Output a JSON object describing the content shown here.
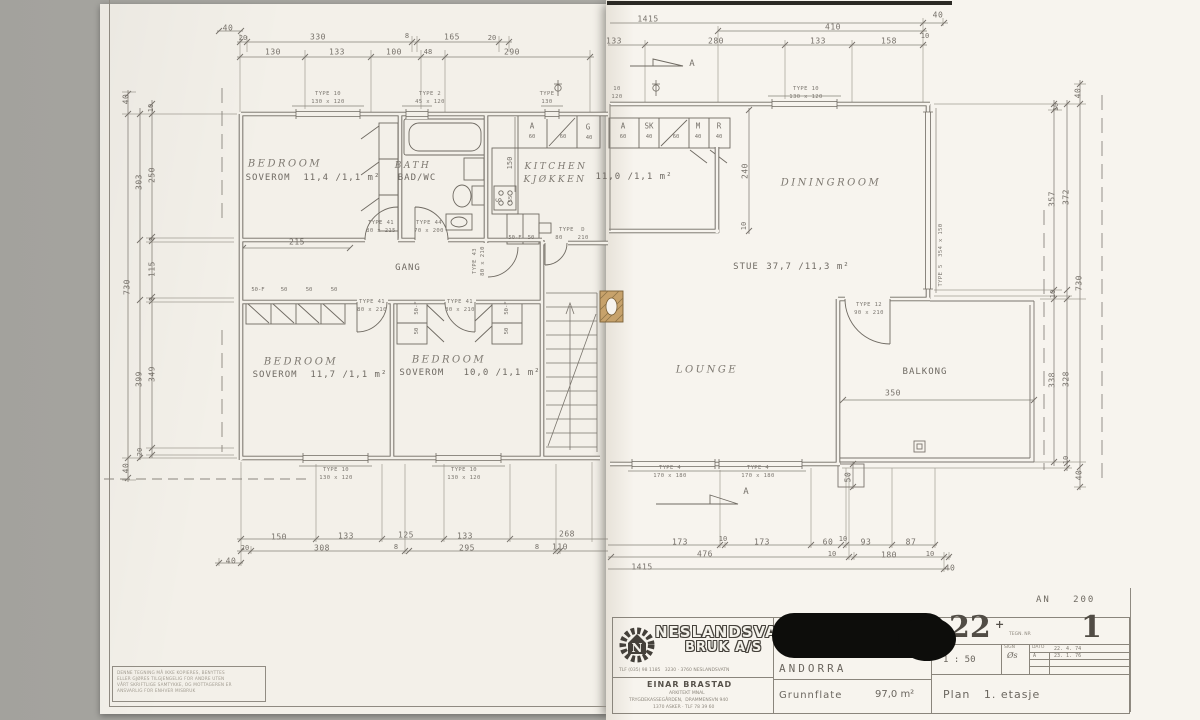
{
  "page": {
    "backdrop": "#a8a7a2",
    "paper_left": "#f3f0e9",
    "paper_right": "#f7f4ee",
    "ink": "#6f6a62",
    "chimney_fill": "#c7a26b",
    "redaction": "#0d0d0b"
  },
  "plan": {
    "rooms": [
      {
        "name_en": "BEDROOM",
        "name_no": "SOVEROM",
        "area": "11,4 /1,1 m²"
      },
      {
        "name_en": "BATH",
        "name_no": "BAD/WC"
      },
      {
        "name_en": "KITCHEN",
        "name_no": "KJØKKEN",
        "area": "11,0 /1,1 m²"
      },
      {
        "name_en": "DININGROOM",
        "name_no": "STUE",
        "area": "37,7 /11,3 m²"
      },
      {
        "name_en": "LOUNGE"
      },
      {
        "name_no": "BALKONG"
      },
      {
        "name_en": "BEDROOM",
        "name_no": "SOVEROM",
        "area": "11,7 /1,1 m²"
      },
      {
        "name_en": "BEDROOM",
        "name_no": "SOVEROM",
        "area": "10,0 /1,1 m²"
      },
      {
        "name_no": "GANG"
      }
    ],
    "labels": [
      {
        "t": "40",
        "x": 228,
        "y": 28,
        "c": "dim"
      },
      {
        "t": "20",
        "x": 243,
        "y": 38,
        "c": "dimS"
      },
      {
        "t": "330",
        "x": 318,
        "y": 37,
        "c": "dim"
      },
      {
        "t": "8",
        "x": 407,
        "y": 36,
        "c": "dimS"
      },
      {
        "t": "165",
        "x": 452,
        "y": 37,
        "c": "dim"
      },
      {
        "t": "20",
        "x": 492,
        "y": 38,
        "c": "dimS"
      },
      {
        "t": "130",
        "x": 273,
        "y": 52,
        "c": "dim"
      },
      {
        "t": "133",
        "x": 337,
        "y": 52,
        "c": "dim"
      },
      {
        "t": "100",
        "x": 394,
        "y": 52,
        "c": "dim"
      },
      {
        "t": "48",
        "x": 428,
        "y": 52,
        "c": "dimS"
      },
      {
        "t": "290",
        "x": 512,
        "y": 52,
        "c": "dim"
      },
      {
        "t": "1415",
        "x": 648,
        "y": 19,
        "c": "dim"
      },
      {
        "t": "410",
        "x": 833,
        "y": 27,
        "c": "dim"
      },
      {
        "t": "40",
        "x": 938,
        "y": 15,
        "c": "dim"
      },
      {
        "t": "133",
        "x": 614,
        "y": 41,
        "c": "dim"
      },
      {
        "t": "280",
        "x": 716,
        "y": 41,
        "c": "dim"
      },
      {
        "t": "133",
        "x": 818,
        "y": 41,
        "c": "dim"
      },
      {
        "t": "158",
        "x": 889,
        "y": 41,
        "c": "dim"
      },
      {
        "t": "10",
        "x": 925,
        "y": 36,
        "c": "dimS"
      },
      {
        "t": "A",
        "x": 692,
        "y": 64,
        "c": "secA"
      },
      {
        "t": "A",
        "x": 746,
        "y": 492,
        "c": "secA"
      },
      {
        "t": "TYPE 10",
        "x": 328,
        "y": 94,
        "c": "tiny"
      },
      {
        "t": "130 x 120",
        "x": 328,
        "y": 102,
        "c": "tiny"
      },
      {
        "t": "TYPE 2",
        "x": 430,
        "y": 94,
        "c": "tiny"
      },
      {
        "t": "45 x 120",
        "x": 430,
        "y": 102,
        "c": "tiny"
      },
      {
        "t": "TYPE",
        "x": 547,
        "y": 94,
        "c": "tiny"
      },
      {
        "t": "130",
        "x": 547,
        "y": 102,
        "c": "tiny"
      },
      {
        "t": "10",
        "x": 617,
        "y": 89,
        "c": "tiny"
      },
      {
        "t": "120",
        "x": 617,
        "y": 97,
        "c": "tiny"
      },
      {
        "t": "TYPE 10",
        "x": 806,
        "y": 89,
        "c": "tiny"
      },
      {
        "t": "130 x 120",
        "x": 806,
        "y": 97,
        "c": "tiny"
      },
      {
        "t": "TYPE 5  354 x 150",
        "x": 941,
        "y": 255,
        "c": "tiny rot"
      },
      {
        "t": "TYPE 12",
        "x": 869,
        "y": 305,
        "c": "tiny"
      },
      {
        "t": "90 x 210",
        "x": 869,
        "y": 313,
        "c": "tiny"
      },
      {
        "t": "TYPE 41",
        "x": 381,
        "y": 223,
        "c": "tiny"
      },
      {
        "t": "80 x 215",
        "x": 381,
        "y": 231,
        "c": "tiny"
      },
      {
        "t": "TYPE 44",
        "x": 429,
        "y": 223,
        "c": "tiny"
      },
      {
        "t": "70 x 200",
        "x": 429,
        "y": 231,
        "c": "tiny"
      },
      {
        "t": "TYPE 43",
        "x": 475,
        "y": 261,
        "c": "tiny rot"
      },
      {
        "t": "80 x 210",
        "x": 483,
        "y": 261,
        "c": "tiny rot"
      },
      {
        "t": "TYPE  D",
        "x": 572,
        "y": 230,
        "c": "tiny"
      },
      {
        "t": "80    210",
        "x": 572,
        "y": 238,
        "c": "tiny"
      },
      {
        "t": "TYPE 41",
        "x": 372,
        "y": 302,
        "c": "tiny"
      },
      {
        "t": "80 x 210",
        "x": 372,
        "y": 310,
        "c": "tiny"
      },
      {
        "t": "TYPE 41",
        "x": 460,
        "y": 302,
        "c": "tiny"
      },
      {
        "t": "80 x 210",
        "x": 460,
        "y": 310,
        "c": "tiny"
      },
      {
        "t": "TYPE 10",
        "x": 336,
        "y": 470,
        "c": "tiny"
      },
      {
        "t": "130 x 120",
        "x": 336,
        "y": 478,
        "c": "tiny"
      },
      {
        "t": "TYPE 10",
        "x": 464,
        "y": 470,
        "c": "tiny"
      },
      {
        "t": "130 x 120",
        "x": 464,
        "y": 478,
        "c": "tiny"
      },
      {
        "t": "TYPE 4",
        "x": 670,
        "y": 468,
        "c": "tiny"
      },
      {
        "t": "170 x 180",
        "x": 670,
        "y": 476,
        "c": "tiny"
      },
      {
        "t": "TYPE 4",
        "x": 758,
        "y": 468,
        "c": "tiny"
      },
      {
        "t": "170 x 180",
        "x": 758,
        "y": 476,
        "c": "tiny"
      },
      {
        "t": "A",
        "x": 532,
        "y": 126,
        "c": "clo"
      },
      {
        "t": "60",
        "x": 532,
        "y": 137,
        "c": "cloS"
      },
      {
        "t": "60",
        "x": 563,
        "y": 137,
        "c": "cloS"
      },
      {
        "t": "G",
        "x": 588,
        "y": 127,
        "c": "clo"
      },
      {
        "t": "40",
        "x": 589,
        "y": 138,
        "c": "cloS"
      },
      {
        "t": "A",
        "x": 623,
        "y": 126,
        "c": "clo"
      },
      {
        "t": "60",
        "x": 623,
        "y": 137,
        "c": "cloS"
      },
      {
        "t": "SK",
        "x": 649,
        "y": 126,
        "c": "clo"
      },
      {
        "t": "40",
        "x": 649,
        "y": 137,
        "c": "cloS"
      },
      {
        "t": "60",
        "x": 676,
        "y": 137,
        "c": "cloS"
      },
      {
        "t": "M",
        "x": 698,
        "y": 126,
        "c": "clo"
      },
      {
        "t": "40",
        "x": 698,
        "y": 137,
        "c": "cloS"
      },
      {
        "t": "R",
        "x": 719,
        "y": 126,
        "c": "clo"
      },
      {
        "t": "40",
        "x": 719,
        "y": 137,
        "c": "cloS"
      },
      {
        "t": "50-F",
        "x": 258,
        "y": 290,
        "c": "cloS"
      },
      {
        "t": "50",
        "x": 284,
        "y": 290,
        "c": "cloS"
      },
      {
        "t": "50",
        "x": 309,
        "y": 290,
        "c": "cloS"
      },
      {
        "t": "50",
        "x": 334,
        "y": 290,
        "c": "cloS"
      },
      {
        "t": "50-F",
        "x": 417,
        "y": 308,
        "c": "cloS rot"
      },
      {
        "t": "50",
        "x": 417,
        "y": 331,
        "c": "cloS rot"
      },
      {
        "t": "50-F",
        "x": 507,
        "y": 308,
        "c": "cloS rot"
      },
      {
        "t": "50",
        "x": 507,
        "y": 331,
        "c": "cloS rot"
      },
      {
        "t": "50-F",
        "x": 515,
        "y": 238,
        "c": "cloS"
      },
      {
        "t": "50",
        "x": 531,
        "y": 238,
        "c": "cloS"
      },
      {
        "t": "150",
        "x": 510,
        "y": 163,
        "c": "dimS rot"
      },
      {
        "t": "S",
        "x": 499,
        "y": 200,
        "c": "clo rot"
      },
      {
        "t": "55",
        "x": 511,
        "y": 199,
        "c": "cloS rot"
      },
      {
        "t": "BEDROOM",
        "x": 285,
        "y": 164,
        "c": "hw"
      },
      {
        "t": "SOVEROM  11,4 /1,1 m²",
        "x": 313,
        "y": 178,
        "c": "room"
      },
      {
        "t": "BATH",
        "x": 413,
        "y": 166,
        "c": "hw2"
      },
      {
        "t": "BAD/WC",
        "x": 417,
        "y": 178,
        "c": "room"
      },
      {
        "t": "KITCHEN",
        "x": 556,
        "y": 167,
        "c": "hw2"
      },
      {
        "t": "KJØKKEN",
        "x": 555,
        "y": 180,
        "c": "hw2"
      },
      {
        "t": "11,0 /1,1 m²",
        "x": 634,
        "y": 177,
        "c": "room"
      },
      {
        "t": "DININGROOM",
        "x": 831,
        "y": 183,
        "c": "hw"
      },
      {
        "t": "STUE",
        "x": 746,
        "y": 267,
        "c": "room"
      },
      {
        "t": "37,7 /11,3 m²",
        "x": 808,
        "y": 267,
        "c": "room"
      },
      {
        "t": "LOUNGE",
        "x": 707,
        "y": 370,
        "c": "hw"
      },
      {
        "t": "BALKONG",
        "x": 925,
        "y": 372,
        "c": "room"
      },
      {
        "t": "BEDROOM",
        "x": 301,
        "y": 362,
        "c": "hw"
      },
      {
        "t": "SOVEROM  11,7 /1,1 m²",
        "x": 320,
        "y": 375,
        "c": "room"
      },
      {
        "t": "BEDROOM",
        "x": 449,
        "y": 360,
        "c": "hw"
      },
      {
        "t": "SOVEROM   10,0 /1,1 m²",
        "x": 470,
        "y": 373,
        "c": "room"
      },
      {
        "t": "GANG",
        "x": 408,
        "y": 268,
        "c": "room"
      },
      {
        "t": "215",
        "x": 297,
        "y": 242,
        "c": "dim"
      },
      {
        "t": "240",
        "x": 745,
        "y": 171,
        "c": "dim rot"
      },
      {
        "t": "10",
        "x": 744,
        "y": 226,
        "c": "dimS rot"
      },
      {
        "t": "350",
        "x": 893,
        "y": 393,
        "c": "dim"
      },
      {
        "t": "50",
        "x": 848,
        "y": 477,
        "c": "dim rot"
      },
      {
        "t": "40",
        "x": 126,
        "y": 99,
        "c": "dim rot"
      },
      {
        "t": "10",
        "x": 151,
        "y": 108,
        "c": "dimS rot"
      },
      {
        "t": "250",
        "x": 152,
        "y": 175,
        "c": "dim rot"
      },
      {
        "t": "303",
        "x": 139,
        "y": 182,
        "c": "dim rot"
      },
      {
        "t": "8",
        "x": 152,
        "y": 239,
        "c": "dimS rot"
      },
      {
        "t": "115",
        "x": 152,
        "y": 269,
        "c": "dim rot"
      },
      {
        "t": "730",
        "x": 127,
        "y": 287,
        "c": "dim rot"
      },
      {
        "t": "8",
        "x": 152,
        "y": 299,
        "c": "dimS rot"
      },
      {
        "t": "399",
        "x": 139,
        "y": 379,
        "c": "dim rot"
      },
      {
        "t": "349",
        "x": 152,
        "y": 374,
        "c": "dim rot"
      },
      {
        "t": "20",
        "x": 140,
        "y": 452,
        "c": "dimS rot"
      },
      {
        "t": "40",
        "x": 126,
        "y": 468,
        "c": "dim rot"
      },
      {
        "t": "40",
        "x": 1078,
        "y": 93,
        "c": "dim rot"
      },
      {
        "t": "10",
        "x": 1056,
        "y": 107,
        "c": "dimS rot"
      },
      {
        "t": "357",
        "x": 1052,
        "y": 199,
        "c": "dim rot"
      },
      {
        "t": "372",
        "x": 1066,
        "y": 197,
        "c": "dim rot"
      },
      {
        "t": "730",
        "x": 1079,
        "y": 283,
        "c": "dim rot"
      },
      {
        "t": "10",
        "x": 1053,
        "y": 294,
        "c": "dimS rot"
      },
      {
        "t": "338",
        "x": 1052,
        "y": 380,
        "c": "dim rot"
      },
      {
        "t": "328",
        "x": 1066,
        "y": 379,
        "c": "dim rot"
      },
      {
        "t": "10",
        "x": 1066,
        "y": 460,
        "c": "dimS rot"
      },
      {
        "t": "40",
        "x": 1079,
        "y": 475,
        "c": "dim rot"
      },
      {
        "t": "150",
        "x": 279,
        "y": 537,
        "c": "dim"
      },
      {
        "t": "133",
        "x": 346,
        "y": 536,
        "c": "dim"
      },
      {
        "t": "125",
        "x": 406,
        "y": 535,
        "c": "dim"
      },
      {
        "t": "133",
        "x": 465,
        "y": 536,
        "c": "dim"
      },
      {
        "t": "268",
        "x": 567,
        "y": 534,
        "c": "dim"
      },
      {
        "t": "20",
        "x": 245,
        "y": 548,
        "c": "dimS"
      },
      {
        "t": "308",
        "x": 322,
        "y": 548,
        "c": "dim"
      },
      {
        "t": "8",
        "x": 396,
        "y": 547,
        "c": "dimS"
      },
      {
        "t": "295",
        "x": 467,
        "y": 548,
        "c": "dim"
      },
      {
        "t": "8",
        "x": 537,
        "y": 547,
        "c": "dimS"
      },
      {
        "t": "110",
        "x": 560,
        "y": 547,
        "c": "dim"
      },
      {
        "t": "40",
        "x": 231,
        "y": 561,
        "c": "dim"
      },
      {
        "t": "173",
        "x": 680,
        "y": 542,
        "c": "dim"
      },
      {
        "t": "10",
        "x": 723,
        "y": 539,
        "c": "dimS"
      },
      {
        "t": "173",
        "x": 762,
        "y": 542,
        "c": "dim"
      },
      {
        "t": "60",
        "x": 828,
        "y": 542,
        "c": "dim"
      },
      {
        "t": "10",
        "x": 843,
        "y": 539,
        "c": "dimS"
      },
      {
        "t": "93",
        "x": 866,
        "y": 542,
        "c": "dim"
      },
      {
        "t": "87",
        "x": 911,
        "y": 542,
        "c": "dim"
      },
      {
        "t": "476",
        "x": 705,
        "y": 554,
        "c": "dim"
      },
      {
        "t": "10",
        "x": 832,
        "y": 554,
        "c": "dimS"
      },
      {
        "t": "180",
        "x": 889,
        "y": 555,
        "c": "dim"
      },
      {
        "t": "10",
        "x": 930,
        "y": 554,
        "c": "dimS"
      },
      {
        "t": "1415",
        "x": 642,
        "y": 567,
        "c": "dim"
      },
      {
        "t": "40",
        "x": 950,
        "y": 568,
        "c": "dim"
      }
    ]
  },
  "title_block": {
    "ref": "AN   200",
    "company_line1": "NESLANDSVATN",
    "company_line2": "BRUK A/S",
    "company_contact": "TLF (035) 98 1185   3230 · 3760 NESLANDSVATN",
    "architect_name": "EINAR BRASTAD",
    "architect_title": "ARKITEKT MNAL",
    "architect_addr1": "TRYGDEKASSEGÅRDEN,  DRAMMENSVN 940",
    "architect_addr2": "1370 ASKER · TLF 78 39 60",
    "logo_letter": "N",
    "project_name": "ANDORRA",
    "area_label": "Grunnflate",
    "area_value": "97,0 m²",
    "type_value": "22",
    "type_plus": "+",
    "drawing_no_label": "TEGN. NR",
    "drawing_no": "1",
    "scale_label": "MÅL",
    "scale_value": "1 : 50",
    "sign_label": "SIGN",
    "sign_value": "Øs",
    "date_label": "DATO",
    "date_1": "22. 4. 74",
    "rev_letter": "A",
    "date_2": "23. 1. 76",
    "plan_label": "Plan   1. etasje",
    "disclaimer": [
      "DENNE TEGNING MÅ IKKE KOPIERES, BENYTTES",
      "ELLER GJØRES TILGJENGELIG FOR ANDRE UTEN",
      "VÅRT SKRIFTLIGE SAMTYKKE, OG MOTTAGEREN ER",
      "ANSVARLIG FOR ENHVER MISBRUK"
    ]
  }
}
